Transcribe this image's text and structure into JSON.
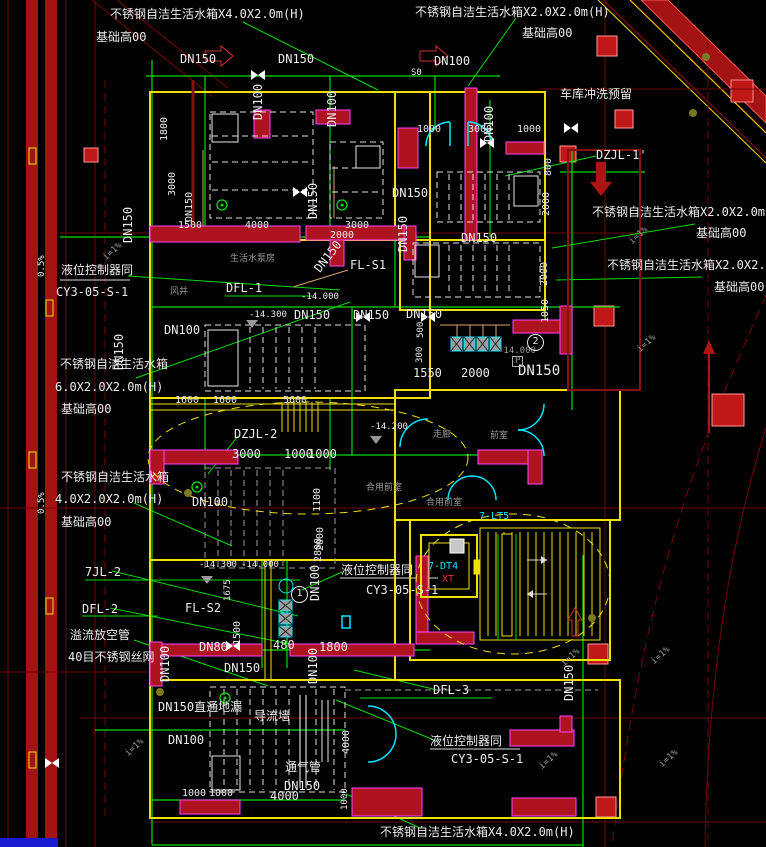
{
  "palette": {
    "pipe_green": "#00dd00",
    "wall_yellow": "#f0e000",
    "structure_red": "#ae1420",
    "structure_magenta": "#ff44ff",
    "road_red": "#a31313",
    "axis_dark_red": "#6f0606",
    "door_cyan": "#00e5ff",
    "text_white": "#ececec",
    "text_gray": "#9a9a9a",
    "pipe_tan": "#d8a268"
  },
  "labels": {
    "tank_4020": "不锈钢自洁生活水箱X4.0X2.0m(H)",
    "tank_2020": "不锈钢自洁生活水箱X2.0X2.0m(H)",
    "tank_name": "不锈钢自洁生活水箱",
    "tank_size_6020": "6.0X2.0X2.0m(H)",
    "tank_size_4020": "4.0X2.0X2.0m(H)",
    "base_height": "基础高00",
    "dn150": "DN150",
    "dn100": "DN100",
    "dn80": "DN80",
    "garage_flush": "车库冲洗预留",
    "dzjl1": "DZJL-1'",
    "dzjl2": "DZJL-2",
    "level_controller": "液位控制器同",
    "cy_model": "CY3-05-S-1",
    "dfl1": "DFL-1",
    "dfl2": "DFL-2",
    "dfl3": "DFL-3",
    "fls1": "FL-S1",
    "fls2": "FL-S2",
    "jl72": "7JL-2",
    "overflow_pipe": "溢流放空管",
    "mesh40": "40目不锈钢丝网",
    "drain_direct": "DN150直通地漏",
    "divert_wall": "导流墙",
    "vent_pipe": "通气管",
    "pump_room": "生活水泵房",
    "air_shaft": "风井",
    "corridor": "走廊",
    "front_room": "前室",
    "shared_front_room": "合用前室",
    "elevator": "7-DT4",
    "elevator_xt": "XT",
    "stair": "7-LT5",
    "slope": "i=1%",
    "slope_05": "0.5%",
    "s0": "S0",
    "p_marker": "P",
    "circle1": "1",
    "circle2": "2",
    "elev_14000": "-14.000",
    "elev_14200": "-14.200",
    "elev_14300": "-14.300",
    "dims": {
      "d300": "300",
      "d480": "480",
      "d500": "500",
      "d800": "800",
      "d1000": "1000",
      "d1050": "1050",
      "d1100": "1100",
      "d1500": "1500",
      "d1550": "1550",
      "d1600": "1600",
      "d1675": "1675",
      "d1800": "1800",
      "d2000": "2000",
      "d2800": "2800",
      "d3000": "3000",
      "d4000": "4000",
      "d5600": "5600"
    }
  }
}
